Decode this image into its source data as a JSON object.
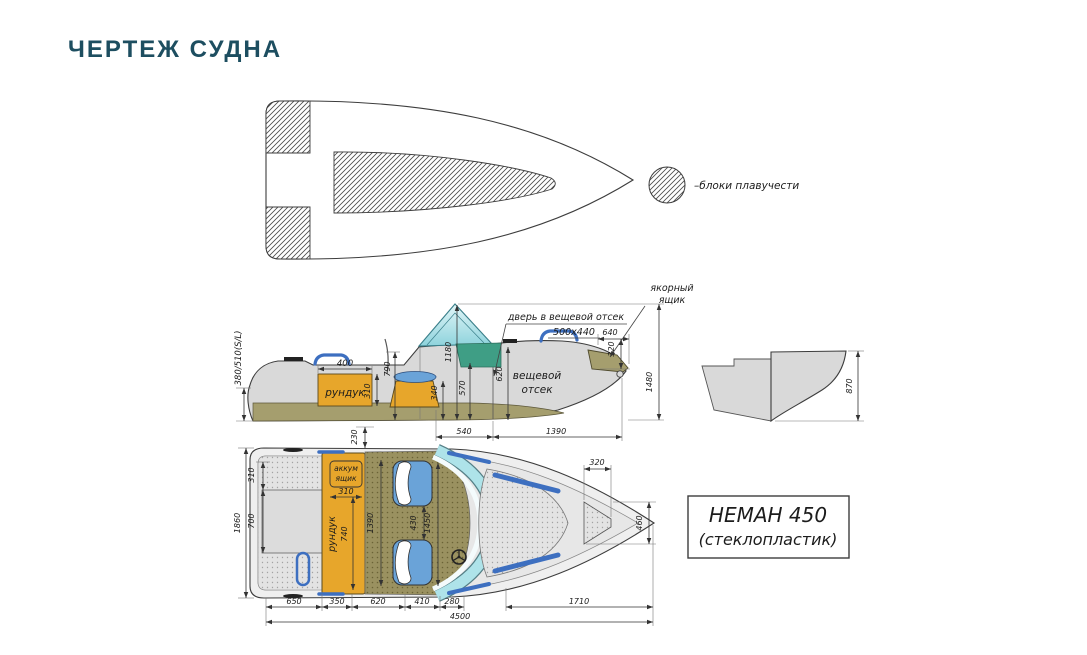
{
  "page": {
    "title": "ЧЕРТЕЖ СУДНА"
  },
  "legend": {
    "label": "–блоки плавучести"
  },
  "side_view": {
    "locker_label": "рундук",
    "stowage_line1": "вещевой",
    "stowage_line2": "отсек",
    "door_label": "дверь в вещевой отсек",
    "door_size": "500x440",
    "anchor_line1": "якорный",
    "anchor_line2": "ящик",
    "dim_board": "380/510(S/L)",
    "dim_400": "400",
    "dim_310": "310",
    "dim_790": "790",
    "dim_1180": "1180",
    "dim_570": "570",
    "dim_340": "340",
    "dim_620": "620",
    "dim_640": "640",
    "dim_320": "320",
    "dim_1480": "1480",
    "dim_540": "540",
    "dim_1390": "1390"
  },
  "transom_view": {
    "dim_870": "870"
  },
  "plan_view": {
    "battery_line1": "аккум",
    "battery_line2": "ящик",
    "battery_dim": "310",
    "locker_label": "рундук",
    "locker_dim": "740",
    "dim_1860": "1860",
    "dim_310": "310",
    "dim_700": "700",
    "dim_230": "230",
    "dim_1390": "1390",
    "dim_430": "430",
    "dim_1450": "1450",
    "dim_320": "320",
    "dim_460": "460",
    "dim_650": "650",
    "dim_350": "350",
    "dim_620": "620",
    "dim_410": "410",
    "dim_280": "280",
    "dim_1710": "1710",
    "dim_4500": "4500"
  },
  "model_label": {
    "line1": "НЕМАН 450",
    "line2": "(стеклопластик)"
  },
  "colors": {
    "title_text": "#1d4e60",
    "outline": "#3d3d3d",
    "hull_fill": "#d9d9d9",
    "deck_fill": "#e7e7e7",
    "bottom_olive": "#a59e6e",
    "floor_olive": "#9a9160",
    "locker_orange": "#e7a62b",
    "seat_blue": "#6aa3d8",
    "console_green": "#3f9e85",
    "windshield_cyan": "#aee3e9",
    "rail_blue": "#3d6fc0"
  }
}
